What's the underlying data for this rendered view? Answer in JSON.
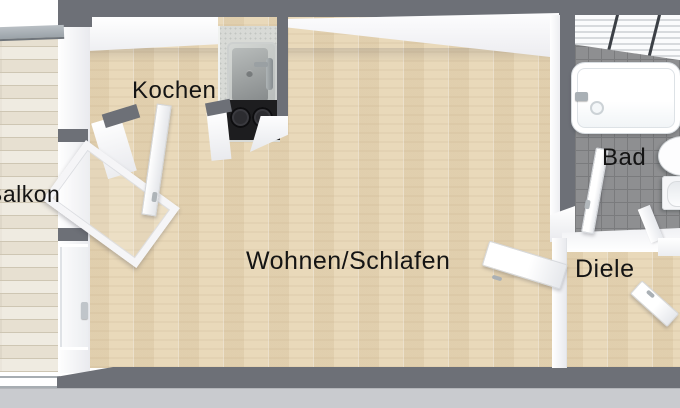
{
  "document_type": "floor-plan",
  "rooms": [
    {
      "id": "balkon",
      "label": "Balkon"
    },
    {
      "id": "kochen",
      "label": "Kochen"
    },
    {
      "id": "wohnen-schlafen",
      "label": "Wohnen/Schlafen"
    },
    {
      "id": "bad",
      "label": "Bad"
    },
    {
      "id": "diele",
      "label": "Diele"
    }
  ],
  "fixtures": [
    "kitchen-sink-icon",
    "cooktop-icon",
    "bathtub-icon",
    "washbasin-icon",
    "toilet-icon",
    "bath-window-icon",
    "balcony-door-icon",
    "room-door-icon",
    "bath-door-icon",
    "entrance-door-icon",
    "balcony-railing-icon",
    "window-icon"
  ],
  "colors": {
    "wall": "#6d7077",
    "wall-face": "#f6f6f8",
    "wood": "#e9d9ba",
    "wood-line": "#d9c6a0",
    "balcony-wood": "#e7e0d1",
    "balcony-line": "#cec6b3",
    "tile": "#8e8f91",
    "grout": "#7a7b7d",
    "counter": "#d8dad6",
    "cooktop": "#1d1d1f",
    "ground": "#c9cbcf",
    "railing": "#9aa2a8",
    "label-text": "#141414",
    "fixture": "#ffffff"
  }
}
